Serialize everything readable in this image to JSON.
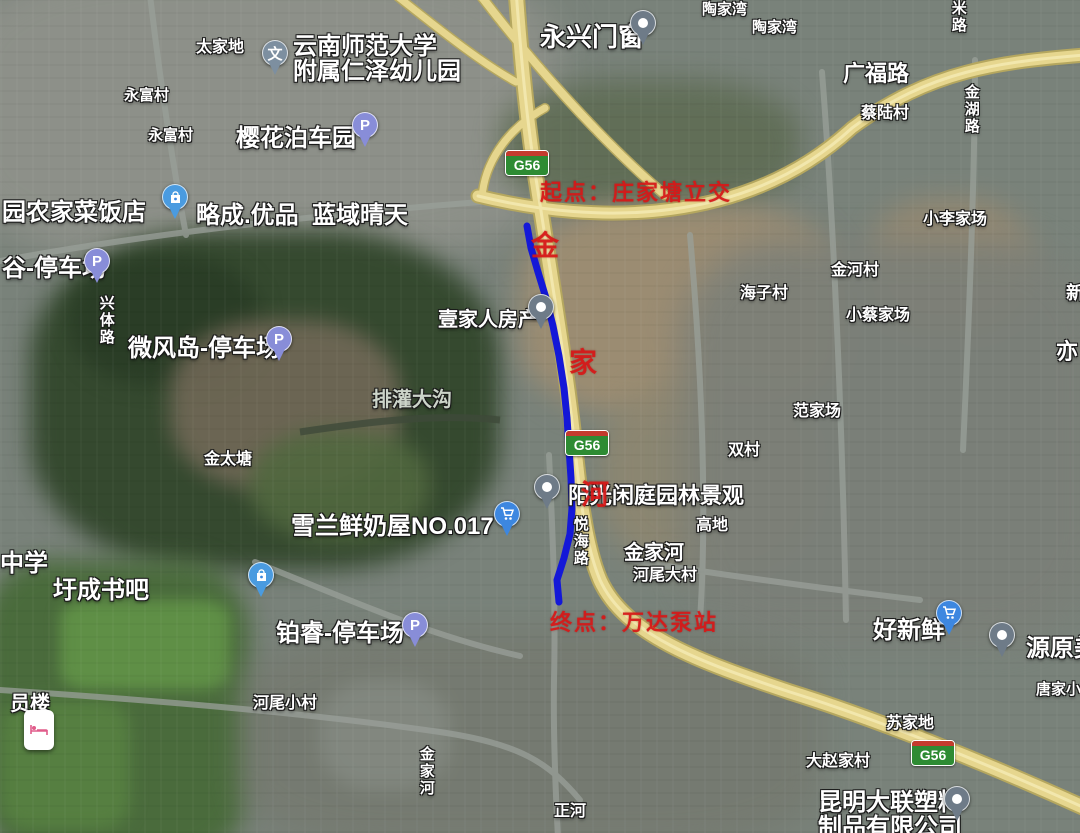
{
  "map": {
    "title_hint": "satellite-route-map",
    "route": {
      "color": "#1418d8",
      "width": 7,
      "points": [
        [
          527,
          226
        ],
        [
          531,
          248
        ],
        [
          538,
          272
        ],
        [
          546,
          298
        ],
        [
          553,
          326
        ],
        [
          559,
          356
        ],
        [
          564,
          388
        ],
        [
          567,
          418
        ],
        [
          569,
          448
        ],
        [
          571,
          478
        ],
        [
          572,
          508
        ],
        [
          570,
          534
        ],
        [
          564,
          558
        ],
        [
          557,
          580
        ],
        [
          559,
          602
        ]
      ]
    },
    "shields": {
      "text": "G56",
      "positions": [
        {
          "x": 505,
          "y": 150
        },
        {
          "x": 565,
          "y": 430
        },
        {
          "x": 911,
          "y": 740
        }
      ]
    },
    "annotations": {
      "start": {
        "text": "起点：庄家塘立交",
        "x": 540,
        "y": 175,
        "size": 22
      },
      "end": {
        "text": "终点：万达泵站",
        "x": 550,
        "y": 605,
        "size": 22
      },
      "river_chars": [
        {
          "text": "金",
          "x": 531,
          "y": 224,
          "size": 28
        },
        {
          "text": "家",
          "x": 569,
          "y": 341,
          "size": 28
        },
        {
          "text": "河",
          "x": 581,
          "y": 473,
          "size": 28
        }
      ]
    },
    "labels": [
      {
        "text": "太家地",
        "x": 196,
        "y": 40,
        "size": 16
      },
      {
        "text": "云南师范大学\n附属仁泽幼儿园",
        "x": 293,
        "y": 34,
        "size": 24
      },
      {
        "text": "樱花泊车园",
        "x": 236,
        "y": 126,
        "size": 24
      },
      {
        "text": "永富村",
        "x": 124,
        "y": 88,
        "size": 15
      },
      {
        "text": "永富村",
        "x": 148,
        "y": 128,
        "size": 15
      },
      {
        "text": "永兴门窗",
        "x": 540,
        "y": 24,
        "size": 26
      },
      {
        "text": "陶家湾",
        "x": 702,
        "y": 2,
        "size": 15
      },
      {
        "text": "陶家湾",
        "x": 752,
        "y": 20,
        "size": 15
      },
      {
        "text": "广福路",
        "x": 843,
        "y": 62,
        "size": 22
      },
      {
        "text": "米路",
        "x": 950,
        "y": 0,
        "size": 15,
        "vertical": true
      },
      {
        "text": "蔡陆村",
        "x": 861,
        "y": 106,
        "size": 16
      },
      {
        "text": "金湖路",
        "x": 963,
        "y": 84,
        "size": 15,
        "vertical": true
      },
      {
        "text": "小李家场",
        "x": 923,
        "y": 212,
        "size": 16
      },
      {
        "text": "新",
        "x": 1066,
        "y": 284,
        "size": 18
      },
      {
        "text": "亦",
        "x": 1056,
        "y": 340,
        "size": 22
      },
      {
        "text": "园农家菜饭店",
        "x": 2,
        "y": 200,
        "size": 24
      },
      {
        "text": "略成.优品",
        "x": 196,
        "y": 203,
        "size": 24
      },
      {
        "text": "蓝域晴天",
        "x": 312,
        "y": 203,
        "size": 24
      },
      {
        "text": "谷-停车场",
        "x": 2,
        "y": 256,
        "size": 24
      },
      {
        "text": "兴体路",
        "x": 98,
        "y": 295,
        "size": 15,
        "vertical": true
      },
      {
        "text": "微风岛-停车场",
        "x": 128,
        "y": 336,
        "size": 24
      },
      {
        "text": "排灌大沟",
        "x": 372,
        "y": 390,
        "size": 20,
        "dim": true
      },
      {
        "text": "壹家人房产",
        "x": 438,
        "y": 310,
        "size": 20
      },
      {
        "text": "金太塘",
        "x": 204,
        "y": 452,
        "size": 16
      },
      {
        "text": "海子村",
        "x": 740,
        "y": 286,
        "size": 16
      },
      {
        "text": "双村",
        "x": 728,
        "y": 443,
        "size": 16
      },
      {
        "text": "范家场",
        "x": 793,
        "y": 404,
        "size": 16
      },
      {
        "text": "金河村",
        "x": 831,
        "y": 263,
        "size": 16
      },
      {
        "text": "小蔡家场",
        "x": 846,
        "y": 308,
        "size": 16
      },
      {
        "text": "雪兰鲜奶屋NO.017",
        "x": 291,
        "y": 514,
        "size": 24
      },
      {
        "text": "阳光闲庭园林景观",
        "x": 568,
        "y": 484,
        "size": 22
      },
      {
        "text": "悦海路",
        "x": 572,
        "y": 516,
        "size": 15,
        "vertical": true
      },
      {
        "text": "金家河",
        "x": 624,
        "y": 543,
        "size": 20
      },
      {
        "text": "河尾大村",
        "x": 633,
        "y": 568,
        "size": 16
      },
      {
        "text": "高地",
        "x": 696,
        "y": 518,
        "size": 16
      },
      {
        "text": "中学",
        "x": 0,
        "y": 551,
        "size": 24
      },
      {
        "text": "圩成书吧",
        "x": 53,
        "y": 578,
        "size": 24
      },
      {
        "text": "铂睿-停车场",
        "x": 276,
        "y": 621,
        "size": 24
      },
      {
        "text": "员楼",
        "x": 10,
        "y": 694,
        "size": 20
      },
      {
        "text": "河尾小村",
        "x": 253,
        "y": 696,
        "size": 16
      },
      {
        "text": "金家河",
        "x": 418,
        "y": 746,
        "size": 15,
        "vertical": true
      },
      {
        "text": "正河",
        "x": 554,
        "y": 804,
        "size": 16
      },
      {
        "text": "好新鲜",
        "x": 873,
        "y": 618,
        "size": 24
      },
      {
        "text": "源原美",
        "x": 1026,
        "y": 636,
        "size": 24
      },
      {
        "text": "唐家小",
        "x": 1036,
        "y": 682,
        "size": 15
      },
      {
        "text": "苏家地",
        "x": 886,
        "y": 716,
        "size": 16
      },
      {
        "text": "大赵家村",
        "x": 806,
        "y": 754,
        "size": 16
      },
      {
        "text": "昆明大联塑料\n制品有限公司",
        "x": 818,
        "y": 790,
        "size": 24
      }
    ],
    "pins": [
      {
        "type": "school",
        "glyph": "文",
        "x": 262,
        "y": 40
      },
      {
        "type": "parking",
        "glyph": "P",
        "x": 352,
        "y": 112
      },
      {
        "type": "poi",
        "glyph": "",
        "x": 630,
        "y": 10
      },
      {
        "type": "bag",
        "glyph": "",
        "x": 162,
        "y": 184
      },
      {
        "type": "parking",
        "glyph": "P",
        "x": 84,
        "y": 248
      },
      {
        "type": "parking",
        "glyph": "P",
        "x": 266,
        "y": 326
      },
      {
        "type": "poi",
        "glyph": "",
        "x": 528,
        "y": 294
      },
      {
        "type": "cart",
        "glyph": "",
        "x": 494,
        "y": 501
      },
      {
        "type": "poi",
        "glyph": "",
        "x": 534,
        "y": 474
      },
      {
        "type": "bag",
        "glyph": "",
        "x": 248,
        "y": 562
      },
      {
        "type": "parking",
        "glyph": "P",
        "x": 402,
        "y": 612
      },
      {
        "type": "hotel",
        "glyph": "",
        "x": 24,
        "y": 710
      },
      {
        "type": "cart",
        "glyph": "",
        "x": 936,
        "y": 600
      },
      {
        "type": "poi",
        "glyph": "",
        "x": 989,
        "y": 622
      },
      {
        "type": "poi",
        "glyph": "",
        "x": 944,
        "y": 786
      }
    ],
    "colors": {
      "route_blue": "#1418d8",
      "highway_yellow": "#e6d68e",
      "annotation_red": "#d81818",
      "shield_green": "#2e8b33"
    }
  }
}
